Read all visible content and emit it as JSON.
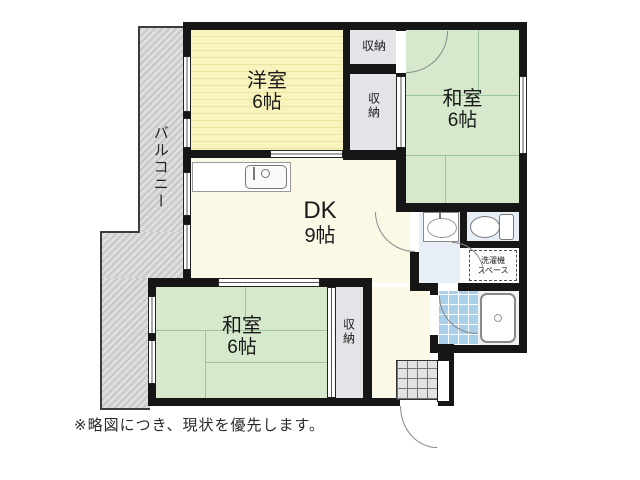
{
  "plan": {
    "rooms": {
      "western": {
        "name": "洋室",
        "size": "6帖"
      },
      "tatami_ne": {
        "name": "和室",
        "size": "6帖"
      },
      "tatami_sw": {
        "name": "和室",
        "size": "6帖"
      },
      "dk": {
        "name": "DK",
        "size": "9帖"
      },
      "balcony": {
        "name": "バルコニー"
      }
    },
    "storages": [
      "収納",
      "収納",
      "収納"
    ],
    "laundry": {
      "line1": "洗濯機",
      "line2": "スペース"
    },
    "note": "※略図につき、現状を優先します。",
    "colors": {
      "wall": "#161616",
      "tatami": "#d6e9cc",
      "western_floor": "#f8f3ba",
      "dk": "#fcf8e6",
      "storage": "#e4e3e8",
      "wet_area": "#e8eef6",
      "bath_tile": "#a9cfe9",
      "balcony_gray": "#d6d6d6"
    }
  }
}
